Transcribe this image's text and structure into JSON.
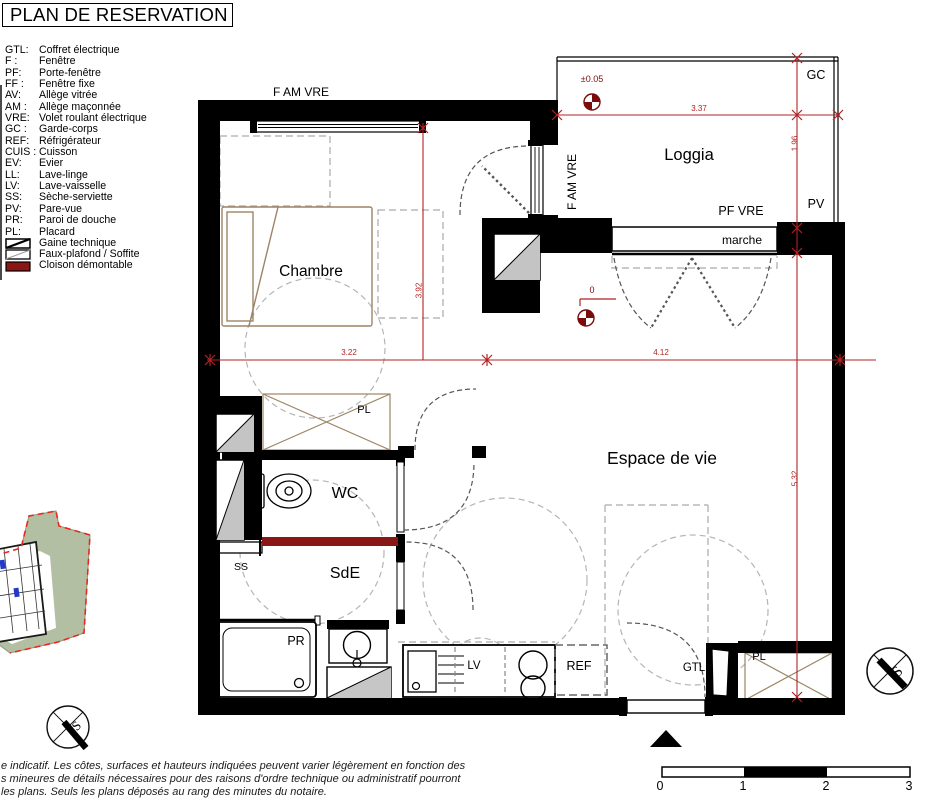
{
  "title": "PLAN DE RESERVATION",
  "legend": {
    "items": [
      {
        "abbr": "GTL:",
        "label": "Coffret électrique"
      },
      {
        "abbr": "F :",
        "label": "Fenêtre"
      },
      {
        "abbr": "PF:",
        "label": "Porte-fenêtre"
      },
      {
        "abbr": "FF :",
        "label": "Fenêtre fixe"
      },
      {
        "abbr": "AV:",
        "label": "Allège vitrée"
      },
      {
        "abbr": "AM :",
        "label": "Allège maçonnée"
      },
      {
        "abbr": "VRE:",
        "label": "Volet roulant électrique"
      },
      {
        "abbr": "GC :",
        "label": "Garde-corps"
      },
      {
        "abbr": "REF:",
        "label": "Réfrigérateur"
      },
      {
        "abbr": "CUIS :",
        "label": "Cuisson"
      },
      {
        "abbr": "EV:",
        "label": "Evier"
      },
      {
        "abbr": "LL:",
        "label": "Lave-linge"
      },
      {
        "abbr": "LV:",
        "label": "Lave-vaisselle"
      },
      {
        "abbr": "SS:",
        "label": "Sèche-serviette"
      },
      {
        "abbr": "PV:",
        "label": "Pare-vue"
      },
      {
        "abbr": "PR:",
        "label": "Paroi de douche"
      },
      {
        "abbr": "PL:",
        "label": "Placard"
      }
    ],
    "symbols": [
      {
        "label": "Gaine technique"
      },
      {
        "label": "Faux-plafond / Soffite"
      },
      {
        "label": "Cloison démontable"
      }
    ]
  },
  "plan": {
    "rooms": {
      "chambre": "Chambre",
      "loggia": "Loggia",
      "espace": "Espace de vie",
      "wc": "WC",
      "sde": "SdE"
    },
    "labels": {
      "f_am_vre_top": "F AM VRE",
      "f_am_vre_side": "F AM VRE",
      "pf_vre": "PF VRE",
      "marche": "marche",
      "gc": "GC",
      "pv": "PV",
      "pl_hall": "PL",
      "pl_entry": "PL",
      "ss": "SS",
      "pr": "PR",
      "lv": "LV",
      "ref": "REF",
      "gtl": "GTL"
    },
    "dimensions": {
      "loggia_width": "3.37",
      "loggia_depth": "1.96",
      "chambre_width": "3.22",
      "espace_width": "4.12",
      "chambre_depth": "3.92",
      "espace_depth": "5.32",
      "level_loggia": "±0.05",
      "level_main": "0"
    },
    "compass": {
      "south": "S"
    }
  },
  "scalebar": {
    "labels": [
      "0",
      "1",
      "2",
      "3"
    ]
  },
  "disclaimer": {
    "line1": "e indicatif. Les côtes, surfaces et hauteurs indiquées peuvent varier légèrement en fonction des",
    "line2": "s mineures de détails nécessaires pour des raisons d'ordre technique ou administratif pourront",
    "line3": "les plans. Seuls les plans déposés au rang des minutes du notaire."
  },
  "colors": {
    "dimension": "#b22222",
    "benchmark": "#7a0c0c",
    "cloison": "#8a1616",
    "wood": "#9c8465",
    "site_green": "#b3bfa2",
    "site_boundary": "#e8281e"
  }
}
